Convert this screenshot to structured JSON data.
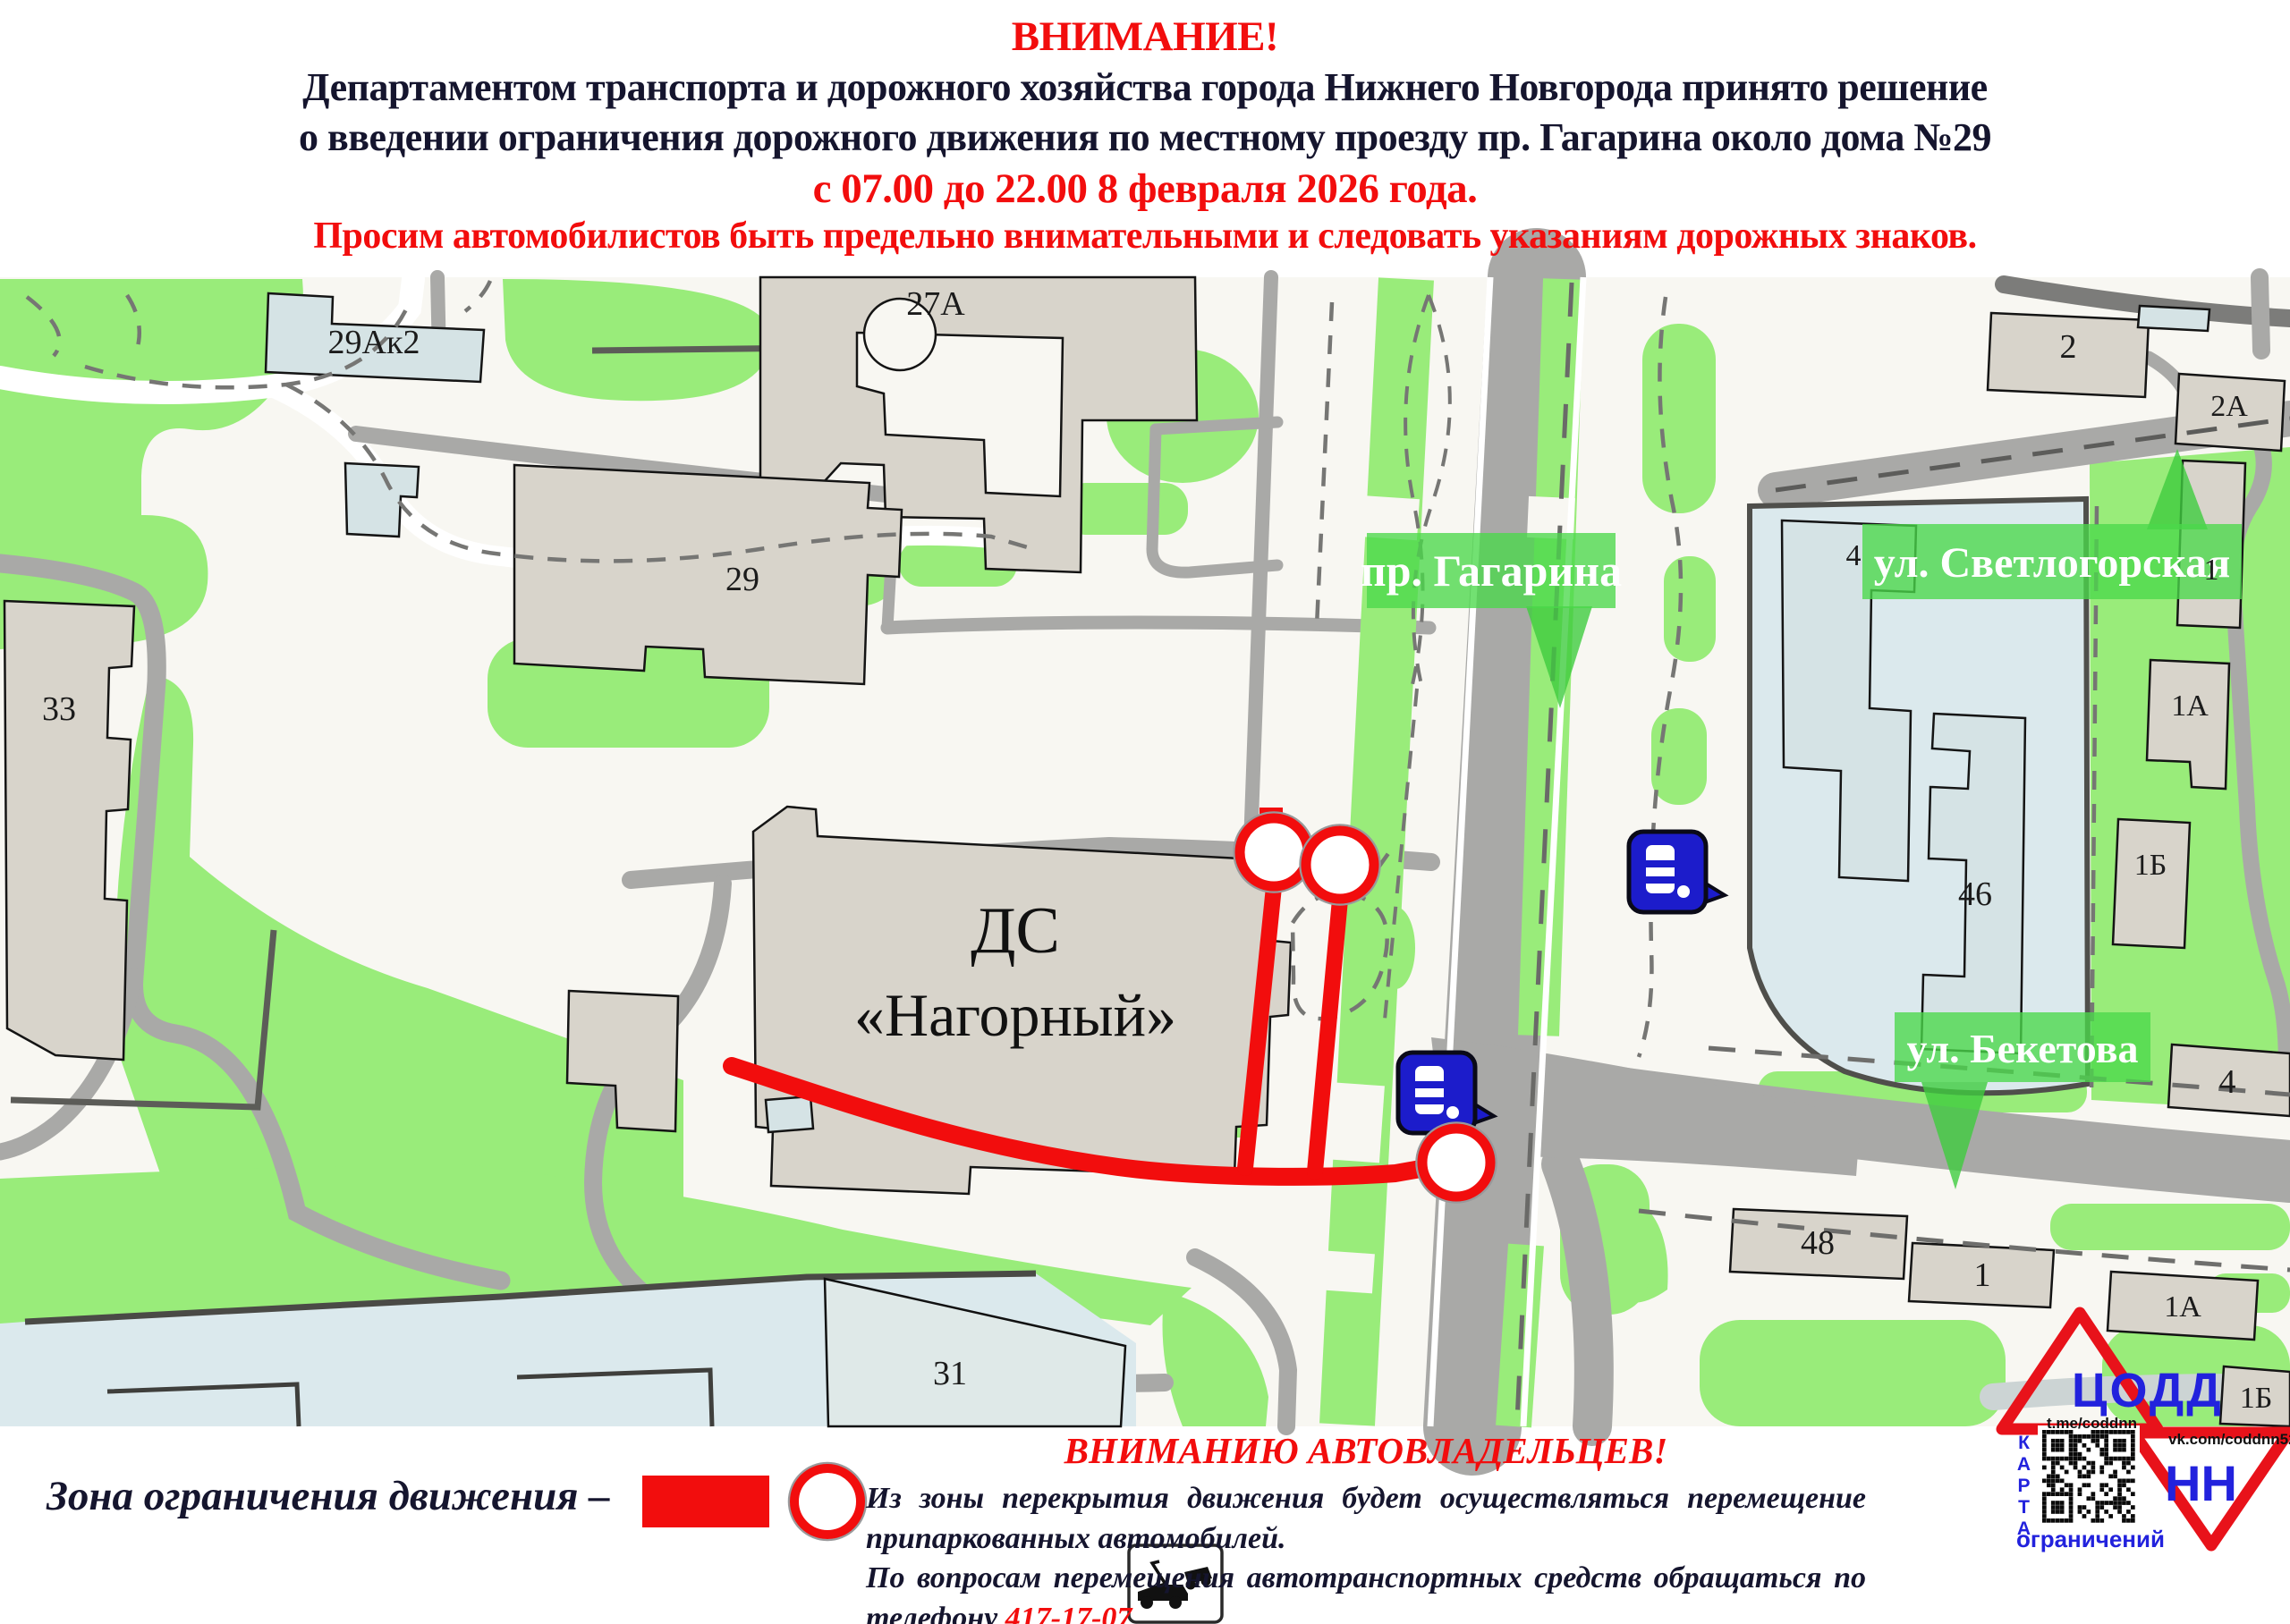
{
  "header": {
    "attention": "ВНИМАНИЕ!",
    "line1": "Департаментом транспорта и дорожного хозяйства города Нижнего Новгорода принято решение",
    "line2": "о введении ограничения дорожного движения по местному проезду пр. Гагарина около дома №29",
    "line3": "с 07.00 до 22.00 8 февраля 2026 года.",
    "line4": "Просим автомобилистов быть предельно внимательными и следовать указаниям дорожных знаков."
  },
  "map": {
    "street_labels": [
      {
        "id": "gagarina",
        "text": "пр. Гагарина"
      },
      {
        "id": "svetlogorskaya",
        "text": "ул. Светлогорская"
      },
      {
        "id": "beketova",
        "text": "ул. Бекетова"
      }
    ],
    "venue": {
      "line1": "ДС",
      "line2": "«Нагорный»"
    },
    "building_labels": [
      "29Ак2",
      "27А",
      "29",
      "33",
      "2",
      "2А",
      "4",
      "1",
      "1А",
      "1Б",
      "46",
      "4",
      "48",
      "1",
      "1А",
      "1Б",
      "31"
    ],
    "icons": [
      "bus-stop",
      "bus-stop"
    ]
  },
  "legend": {
    "label": "Зона ограничения движения –"
  },
  "notice": {
    "title": "ВНИМАНИЮ АВТОВЛАДЕЛЬЦЕВ!",
    "par1": "Из зоны перекрытия движения будет осуществляться перемещение припаркованных автомобилей.",
    "par2": "По вопросам перемещения автотранспортных средств обращаться по телефону ",
    "phone": "417-17-07"
  },
  "logo": {
    "org": "ЦОДД",
    "region": "НН",
    "telegram": "t.me/coddnn",
    "vk": "vk.com/coddnn52",
    "karta": "КАРТА",
    "ogranicheniy": "ограничений"
  },
  "colors": {
    "attention_red": "#f20d0d",
    "header_navy": "#15152e",
    "map_background": "#f8f7f2",
    "map_green": "#99ec7a",
    "road_gray": "#a9a9a7",
    "building_gray": "#d8d4cb",
    "building_blue": "#d5e3e5",
    "campus_blue": "#dbe9ed",
    "banner_green": "#4ad84a",
    "bus_blue": "#1c1ccb",
    "logo_blue": "#2222dd",
    "logo_red": "#e8121a"
  }
}
